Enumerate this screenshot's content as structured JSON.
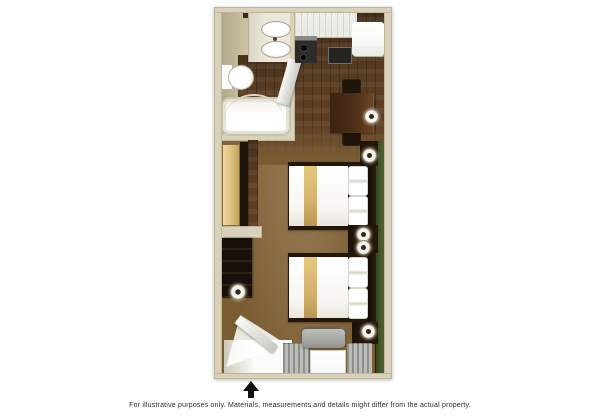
{
  "footer": {
    "disclaimer": "For illustrative purposes only.  Materials, measurements and details might differ from the actual property."
  },
  "entrance": {
    "arrow_glyph": ""
  },
  "colors": {
    "background": "#ffffff",
    "wall": "#d9d2ba",
    "wall_edge": "#b3a98c",
    "bath_wall": "#cbc2a4",
    "wood_floor": "#5d3e23",
    "wood_floor_dark": "#46301b",
    "carpet": "#7a5c33",
    "green_accent": "#4c5c2e",
    "green_accent_dark": "#31411e",
    "counter": "#e9e9e4",
    "appliance_dark": "#2e2b28",
    "fridge": "#f4f4f0",
    "table_wood": "#4e2f17",
    "furniture_dark": "#241709",
    "dresser_black": "#17100a",
    "closet_door": "#dfc183",
    "bed_linen": "#f7f6f2",
    "bed_stripe": "#d3b26e",
    "fixture_white": "#fbfbf8",
    "ptac_gray": "#a8a8a4",
    "arrow_black": "#111111",
    "text": "#2b2b2b"
  }
}
